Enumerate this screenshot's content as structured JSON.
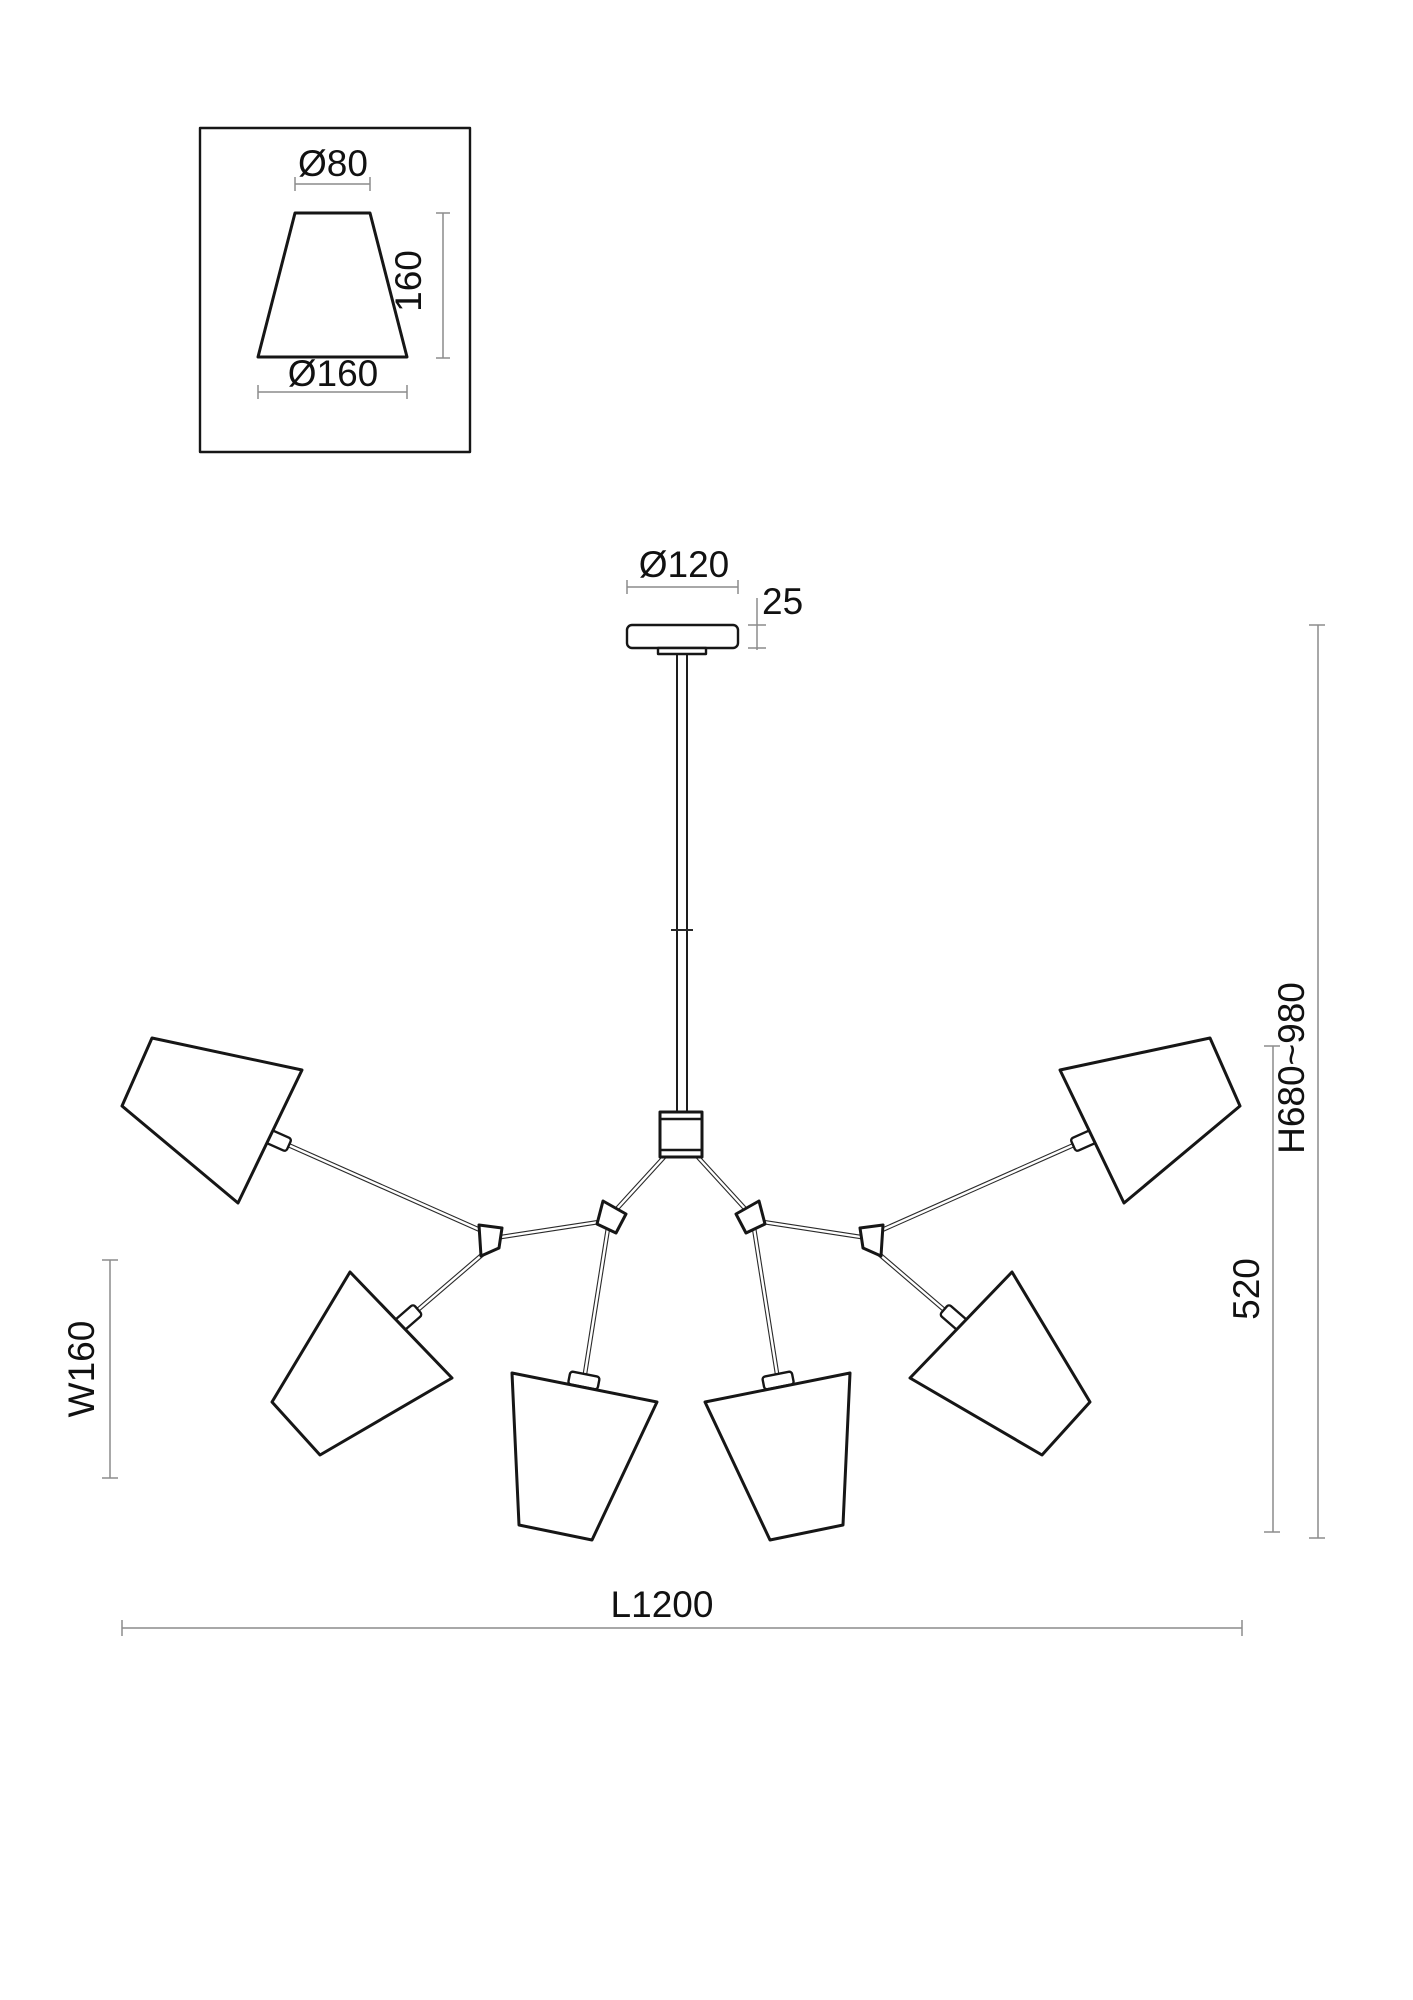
{
  "drawing": {
    "title": "6-light chandelier dimension drawing",
    "colors": {
      "line": "#161616",
      "dimension_line": "#8c8c8c",
      "text": "#111111",
      "background": "#ffffff"
    },
    "inset": {
      "top_diameter": "Ø80",
      "shade_height": "160",
      "bottom_diameter": "Ø160"
    },
    "dimensions": {
      "canopy_diameter": "Ø120",
      "canopy_height": "25",
      "overall_height": "H680~980",
      "body_height": "520",
      "shade_width": "W160",
      "overall_length": "L1200"
    }
  }
}
